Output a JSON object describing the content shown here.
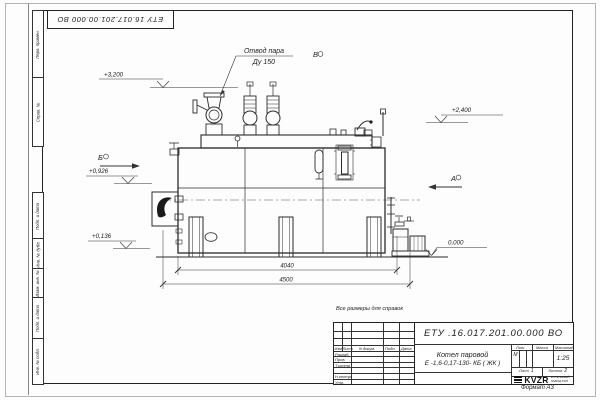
{
  "sheet": {
    "top_stamp": "ЕТУ 16.017.201.00.000  ВО",
    "reference_note": "Все размеры для справок",
    "format_label": "Формат А3",
    "side_columns": {
      "top": [
        "Перв. примен.",
        "Справ. №"
      ],
      "bottom": [
        "Подп. и дата",
        "Инв. № дубл.",
        "Взам. инв. №",
        "Подп. и дата",
        "Инв. № подл."
      ]
    }
  },
  "drawing": {
    "callout": {
      "line1": "Отвод пара",
      "line2": "Ду 150"
    },
    "view_labels": {
      "b": "Б",
      "v": "В",
      "a": "А"
    },
    "elevations": {
      "top": "+3,200",
      "right": "+2,400",
      "mid": "+0,926",
      "low": "+0,136",
      "ground": "0,000"
    },
    "dimensions": {
      "inner": "4040",
      "overall": "4500"
    }
  },
  "title_block": {
    "doc_number": "ЕТУ .16.017.201.00.000  ВО",
    "product_line1": "Котел паровой",
    "product_line2": "Е -1,6-0,17-130- КБ ( ЖК )",
    "header": {
      "izm": "Изм",
      "list": "Лист",
      "doc": "N докум.",
      "podp": "Подп.",
      "data": "Дата"
    },
    "rows": [
      "Разраб.",
      "Пров.",
      "Т.контр",
      "Н.контр",
      "Утв."
    ],
    "lit_label": "Лит.",
    "lit_value": "М",
    "mass_label": "Масса",
    "scale_label": "Масштаб",
    "scale_value": "1:25",
    "list_label": "Лист",
    "list_value": "1",
    "listov_label": "Листов",
    "listov_value": "2",
    "logo_text": "KVZR",
    "logo_sub1": "КОТЕЛЬНЫЙ",
    "logo_sub2": "ЗАВОД РЭП"
  }
}
